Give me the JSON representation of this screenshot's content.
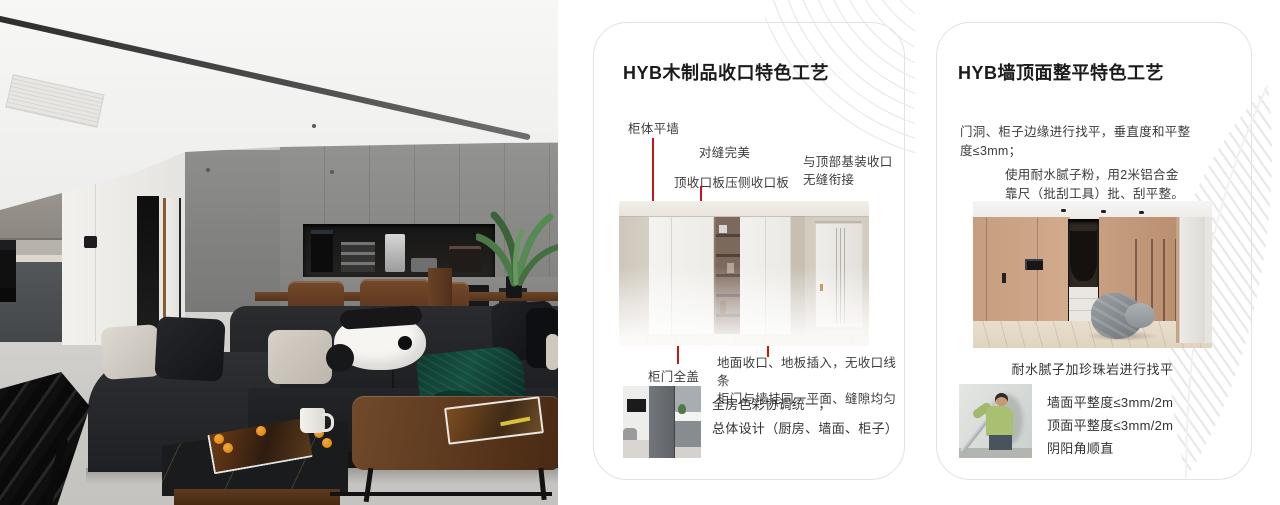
{
  "colors": {
    "accent_red": "#c81515",
    "card_border": "#e2e2e2",
    "deco_line": "#e9e9e9",
    "page_background": "#ffffff"
  },
  "cards": [
    {
      "title": "HYB木制品收口特色工艺",
      "annotations": {
        "cabinet_flat_wall": "柜体平墙",
        "perfect_seam": "对缝完美",
        "top_closing_board": "顶收口板压侧收口板",
        "top_join_line1": "与顶部基装收口",
        "top_join_line2": "无缝衔接",
        "full_cover_door": "柜门全盖",
        "floor_join_line1": "地面收口、地板插入，无收口线条",
        "floor_join_line2": "柜门与墙挂同一平面、缝隙均匀"
      },
      "footer": {
        "line1": "全房色彩协调统一，",
        "line2": "总体设计（厨房、墙面、柜子）"
      }
    },
    {
      "title": "HYB墙顶面整平特色工艺",
      "paragraph1": "门洞、柜子边缘进行找平，垂直度和平整度≤3mm；",
      "paragraph2": "使用耐水腻子粉，用2米铝合金靠尺（批刮工具）批、刮平整。",
      "caption": "耐水腻子加珍珠岩进行找平",
      "specs": {
        "line1": "墙面平整度≤3mm/2m",
        "line2": "顶面平整度≤3mm/2m",
        "line3": "阴阳角顺直"
      }
    }
  ]
}
